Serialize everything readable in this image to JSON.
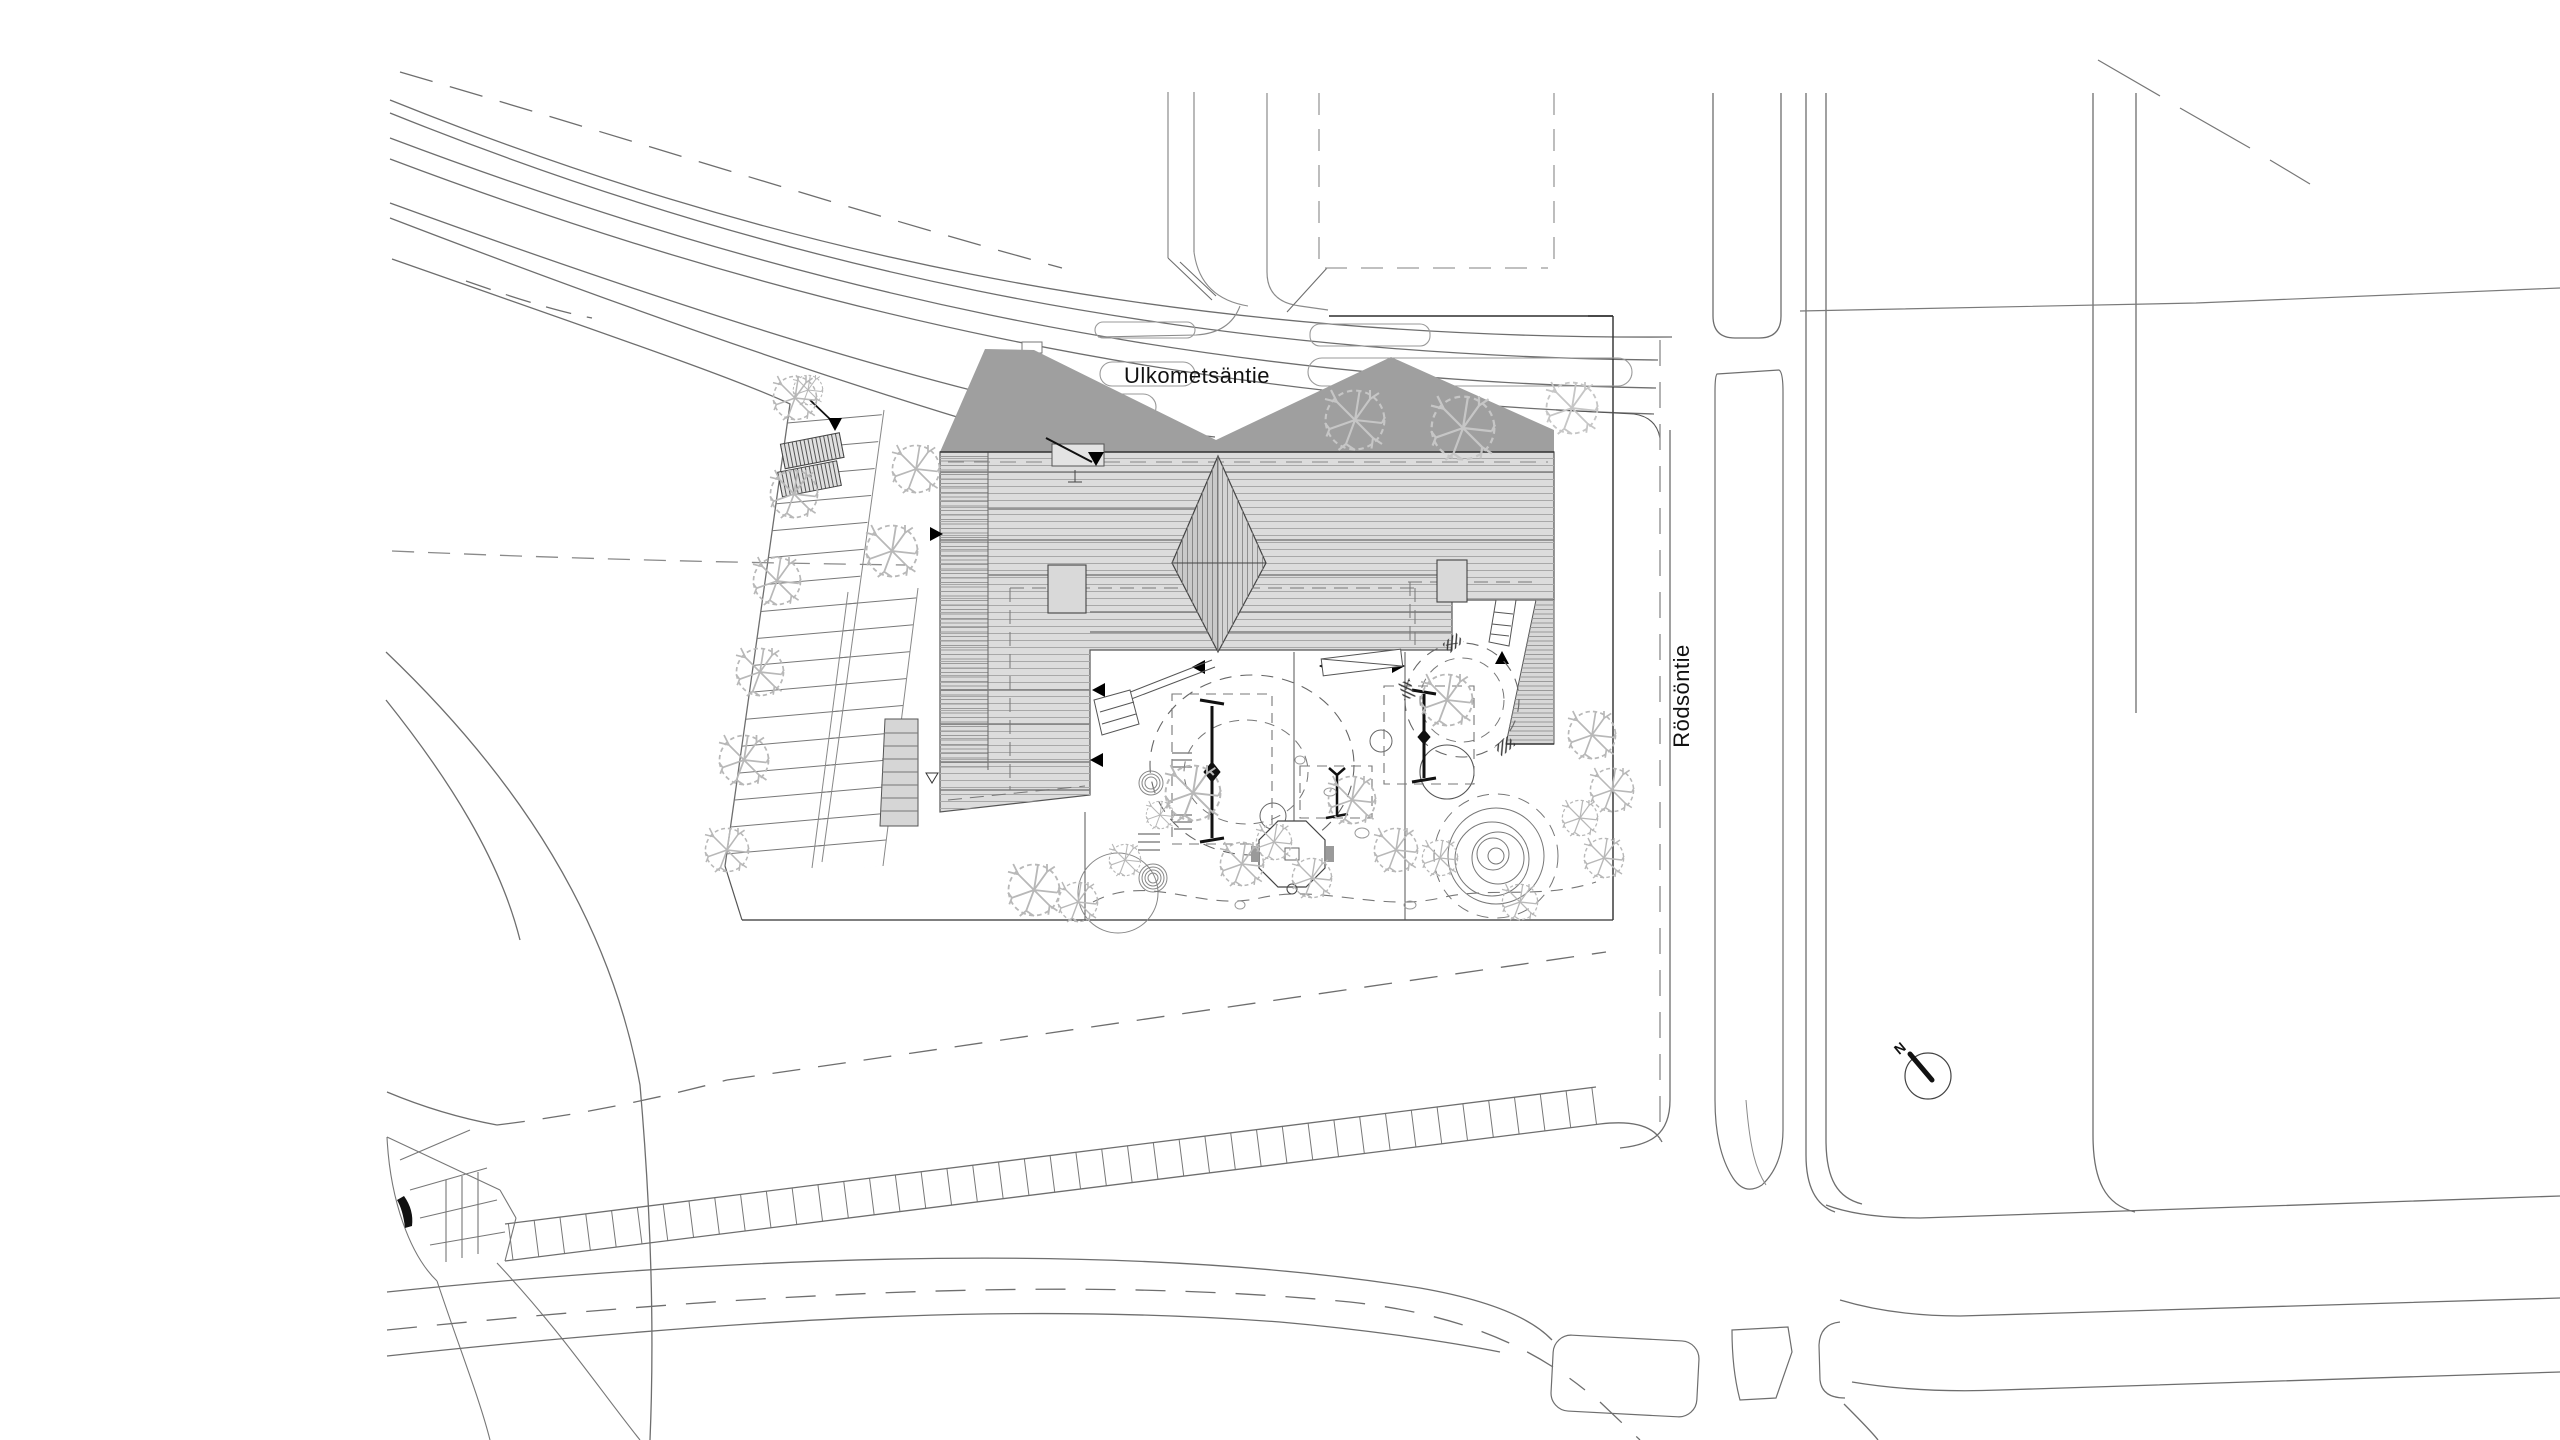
{
  "drawing": {
    "type": "architectural-site-plan",
    "background": "#ffffff"
  },
  "labels": {
    "street_top": "Ulkometsäntie",
    "street_right": "Rödsöntie",
    "compass_north": "N"
  },
  "colors": {
    "road_line": "#6e6e6e",
    "light_line": "#9a9a9a",
    "dark_line": "#2e2e2e",
    "roof_fill": "#dcdcdc",
    "roof_hatch": "#a8a8a8",
    "roof_dense": "#9a9a9a",
    "shadow_fill": "#9f9f9f",
    "tree_stroke": "#b8b8b8",
    "black": "#111111",
    "text": "#111111"
  }
}
